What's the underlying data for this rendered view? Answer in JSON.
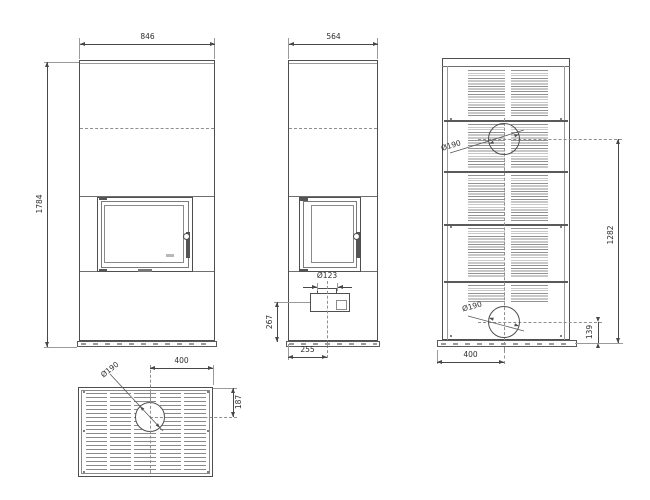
{
  "colors": {
    "line": "#4f4f4f",
    "dim_line": "#474747",
    "text": "#2e2e2e",
    "light": "#9a9a9a",
    "slat": "#909090",
    "background": "#ffffff"
  },
  "views": {
    "front": {
      "width_mm": "846",
      "height_mm": "1784"
    },
    "side": {
      "depth_mm": "564",
      "flue_inlet_diameter": "Ø123",
      "inlet_center_height_mm": "267",
      "inlet_center_offset_mm": "255"
    },
    "rear": {
      "upper_outlet_diameter": "Ø190",
      "lower_outlet_diameter": "Ø190",
      "upper_outlet_center_height_mm": "1282",
      "lower_outlet_center_height_mm": "139",
      "outlet_center_offset_mm": "400"
    },
    "top": {
      "outlet_diameter": "Ø190",
      "outlet_center_offset_mm": "400",
      "outlet_center_depth_mm": "187"
    }
  }
}
